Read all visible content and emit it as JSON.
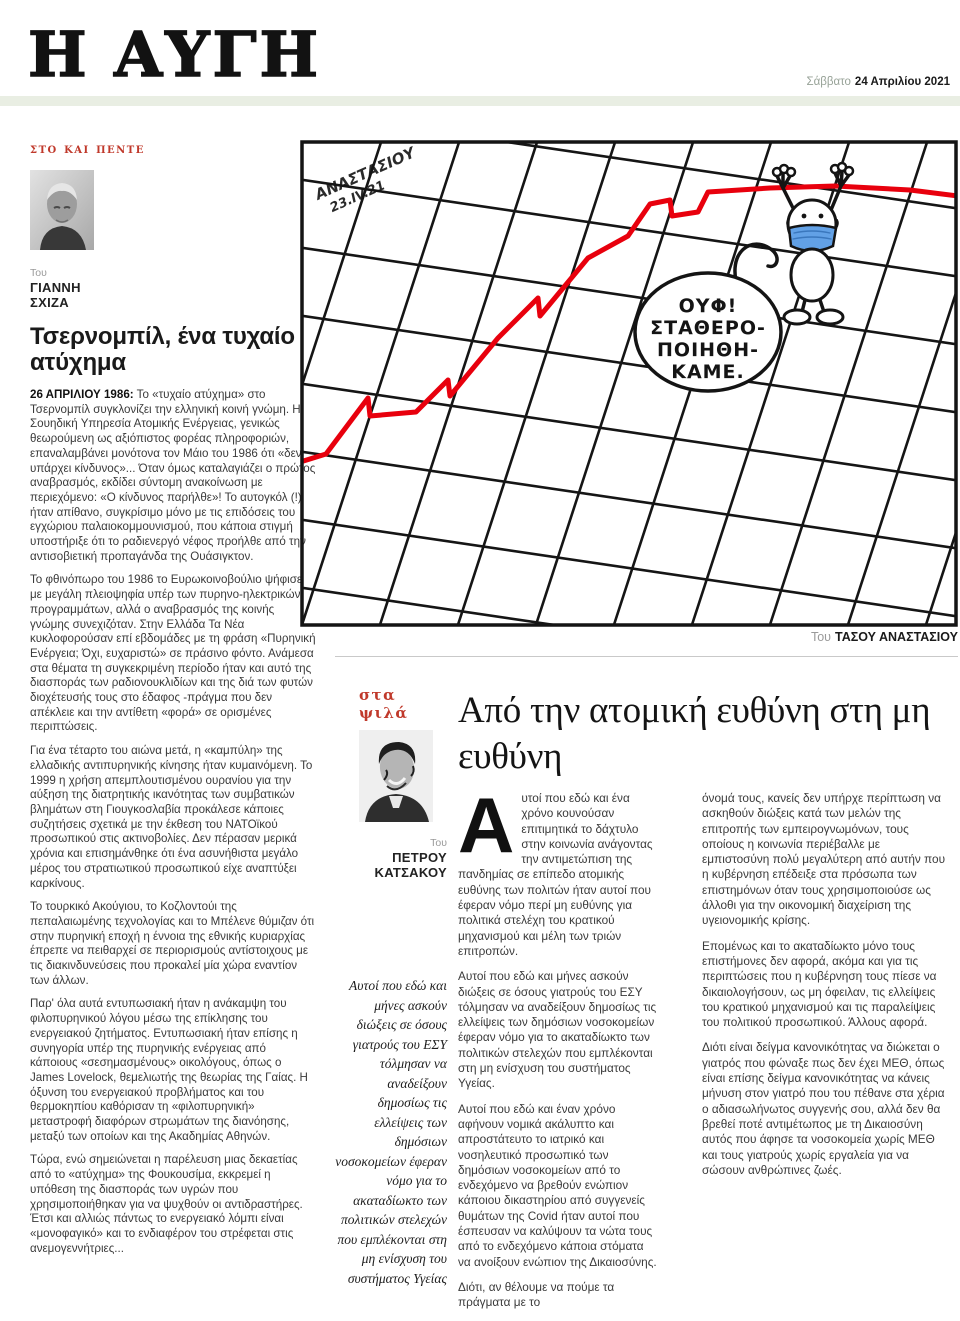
{
  "masthead": {
    "title": "Η ΑΥΓΗ",
    "date_day": "Σάββατο",
    "date_full": "24 Απριλίου 2021"
  },
  "left_article": {
    "section": "στο και πέντε",
    "byline_prefix": "Του",
    "author_line1": "ΓΙΑΝΝΗ",
    "author_line2": "ΣΧΙΖΑ",
    "title": "Τσερνομπίλ, ένα τυχαίο ατύχημα",
    "lead_label": "26 ΑΠΡΙΛΙΟΥ 1986:",
    "lead_rest": "Το «τυχαίο ατύχημα» στο Τσερνομπίλ συγκλονίζει την ελληνική κοινή γνώμη. Η Σουηδική Υπηρεσία Ατομικής Ενέργειας, γενικώς θεωρούμενη ως αξιόπιστος φορέας πληροφοριών, επαναλαμβάνει μονότονα τον Μάιο του 1986 ότι «δεν υπάρχει κίνδυνος»... Όταν όμως καταλαγιάζει ο πρώτος αναβρασμός, εκδίδει σύντομη ανακοίνωση με περιεχόμενο: «Ο κίνδυνος παρήλθε»! Το αυτογκόλ (!) ήταν απίθανο, συγκρίσιμο μόνο με τις επιδόσεις του εγχώριου παλαιοκομμουνισμού, που κάποια στιγμή υποστήριξε ότι το ραδιενεργό νέφος προήλθε από την αντισοβιετική προπαγάνδα της Ουάσιγκτον.",
    "paragraphs": [
      "Το φθινόπωρο του 1986 το Ευρωκοινοβούλιο ψήφισε με μεγάλη πλειοψηφία υπέρ των πυρηνο-ηλεκτρικών προγραμμάτων, αλλά ο αναβρασμός της κοινής γνώμης συνεχιζόταν. Στην Ελλάδα Τα Νέα κυκλοφορούσαν επί εβδομάδες με τη φράση «Πυρηνική Ενέργεια; Όχι, ευχαριστώ» σε πράσινο φόντο. Ανάμεσα στα θέματα τη συγκεκριμένη περίοδο ήταν και αυτό της διασποράς των ραδιονουκλιδίων και της διά των φυτών διοχέτευσής τους στο έδαφος -πράγμα που δεν απέκλειε και την αντίθετη «φορά» σε ορισμένες περιπτώσεις.",
      "Για ένα τέταρτο του αιώνα μετά, η «καμπύλη» της ελλαδικής αντιπυρηνικής κίνησης ήταν κυμαινόμενη. Το 1999 η χρήση απεμπλουτισμένου ουρανίου για την αύξηση της διατρητικής ικανότητας των συμβατικών βλημάτων στη Γιουγκοσλαβία προκάλεσε κάποιες συζητήσεις σχετικά με την έκθεση του ΝΑΤΟϊκού προσωπικού στις ακτινοβολίες. Δεν πέρασαν μερικά χρόνια και επισημάνθηκε ότι ένα ασυνήθιστα μεγάλο μέρος του στρατιωτικού προσωπικού είχε αναπτύξει καρκίνους.",
      "Το τουρκικό Ακούγιου, το Κοζλοντούι της πεπαλαιωμένης τεχνολογίας και το Μπέλενε θύμιζαν ότι στην πυρηνική εποχή η έννοια της εθνικής κυριαρχίας έπρεπε να πειθαρχεί σε περιορισμούς αντίστοιχους με τις διακινδυνεύσεις που προκαλεί μία χώρα εναντίον των άλλων.",
      "Παρ' όλα αυτά εντυπωσιακή ήταν η ανάκαμψη του φιλοπυρηνικού λόγου μέσω της επίκλησης του ενεργειακού ζητήματος. Εντυπωσιακή ήταν επίσης η συνηγορία υπέρ της πυρηνικής ενέργειας από κάποιους «σεσημασμένους» οικολόγους, όπως ο James Lovelock, θεμελιωτής της θεωρίας της Γαίας. Η όξυνση του ενεργειακού προβλήματος και του θερμοκηπίου καθόρισαν τη «φιλοπυρηνική» μεταστροφή διαφόρων στρωμάτων της διανόησης, μεταξύ των οποίων και της Ακαδημίας Αθηνών.",
      "Τώρα, ενώ σημειώνεται η παρέλευση μιας δεκαετίας από το «ατύχημα» της Φουκουσίμα, εκκρεμεί η υπόθεση της διασποράς των υγρών που χρησιμοποιήθηκαν για να ψυχθούν οι αντιδραστήρες. Έτσι και αλλιώς πάντως το ενεργειακό λόμπι είναι «μονοφαγικό» και το ενδιαφέρον του στρέφεται στις ανεμογεννήτριες..."
    ]
  },
  "cartoon": {
    "signature_line1": "ΑΝΑΣΤΑΣΙΟΥ",
    "signature_line2": "23.IV.21",
    "bubble_lines": [
      "ΟΥΦ!",
      "ΣΤΑΘΕΡΟ-",
      "ΠΟΙΗΘΗ-",
      "ΚΑΜΕ."
    ],
    "credit_prefix": "Του",
    "credit_name": "ΤΑΣΟΥ ΑΝΑΣΤΑΣΙΟΥ",
    "colors": {
      "trend_line": "#e8000d",
      "mask_blue": "#62a1e6",
      "ink": "#141414"
    }
  },
  "quote_column": {
    "section": "στα ψιλά",
    "byline_prefix": "Του",
    "author_line1": "ΠΕΤΡΟΥ",
    "author_line2": "ΚΑΤΣΑΚΟΥ",
    "quote": "Αυτοί που εδώ και μήνες ασκούν διώξεις σε όσους γιατρούς του ΕΣΥ τόλμησαν να αναδείξουν δημοσίως τις ελλείψεις των δημόσιων νοσοκομείων έφεραν νόμο για το ακαταδίωκτο των πολιτικών στελεχών που εμπλέκονται στη μη ενίσχυση του συστήματος Υγείας"
  },
  "main_article": {
    "title": "Από την ατομική ευθύνη στη μη ευθύνη",
    "drop_cap": "Α",
    "col1_paragraphs": [
      "υτοί που εδώ και ένα χρόνο κουνούσαν επιτιμητικά το δάχτυλο στην κοινωνία ανάγοντας την αντιμετώπιση της πανδημίας σε επίπεδο ατομικής ευθύνης των πολιτών ήταν αυτοί που έφεραν νόμο περί μη ευθύνης για πολιτικά στελέχη του κρατικού μηχανισμού και μέλη των τριών επιτροπών.",
      "Αυτοί που εδώ και μήνες ασκούν διώξεις σε όσους γιατρούς του ΕΣΥ τόλμησαν να αναδείξουν δημοσίως τις ελλείψεις των δημόσιων νοσοκομείων έφεραν νόμο για το ακαταδίωκτο των πολιτικών στελεχών που εμπλέκονται στη μη ενίσχυση του συστήματος Υγείας.",
      "Αυτοί που εδώ και έναν χρόνο αφήνουν νομικά ακάλυπτο και απροστάτευτο το ιατρικό και νοσηλευτικό προσωπικό των δημόσιων νοσοκομείων από το ενδεχόμενο να βρεθούν ενώπιον κάποιου δικαστηρίου από συγγενείς θυμάτων της Covid ήταν αυτοί που έσπευσαν να καλύψουν τα νώτα τους από το ενδεχόμενο κάποια στόματα να ανοίξουν ενώπιον της Δικαιοσύνης.",
      "Διότι, αν θέλουμε να πούμε τα πράγματα με το"
    ],
    "col2_paragraphs": [
      "όνομά τους, κανείς δεν υπήρχε περίπτωση να ασκηθούν διώξεις κατά των μελών της επιτροπής των εμπειρογνωμόνων, τους οποίους η κοινωνία περιέβαλλε με εμπιστοσύνη πολύ μεγαλύτερη από αυτήν που η κυβέρνηση επέδειξε στα πρόσωπα των επιστημόνων όταν τους χρησιμοποιούσε ως άλλοθι για την οικονομική διαχείριση της υγειονομικής κρίσης.",
      "Επομένως και το ακαταδίωκτο μόνο τους επιστήμονες δεν αφορά, ακόμα και για τις περιπτώσεις που η κυβέρνηση τους πίεσε να δικαιολογήσουν, ως μη όφειλαν, τις ελλείψεις του κρατικού μηχανισμού και τις παραλείψεις του πολιτικού προσωπικού. Άλλους αφορά.",
      "Διότι είναι δείγμα κανονικότητας να διώκεται ο γιατρός που φώναξε πως δεν έχει ΜΕΘ, όπως είναι επίσης δείγμα κανονικότητας να κάνεις μήνυση στον γιατρό που του πέθανε στα χέρια ο αδιασωλήνωτος συγγενής σου, αλλά δεν θα βρεθεί ποτέ αντιμέτωπος με τη Δικαιοσύνη αυτός που άφησε τα νοσοκομεία χωρίς ΜΕΘ και τους γιατρούς χωρίς εργαλεία για να σώσουν ανθρώπινες ζωές."
    ]
  },
  "colors": {
    "accent_red": "#c0392b",
    "band_green": "#e9eee3"
  }
}
